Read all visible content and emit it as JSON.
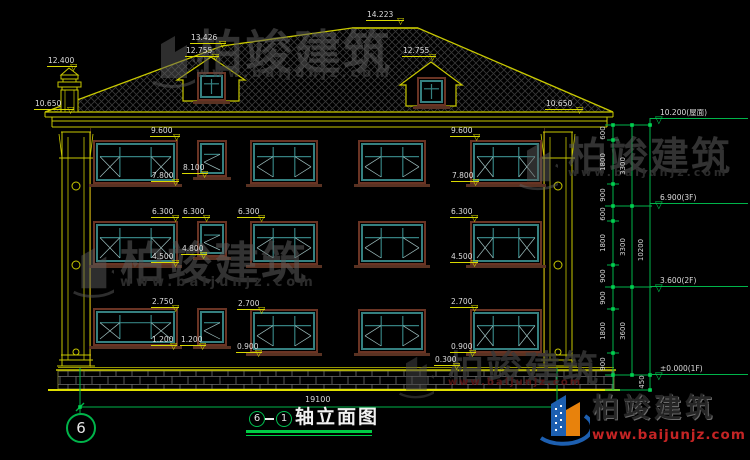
{
  "title_bar": {
    "circle_a": "6",
    "circle_b": "1",
    "title": "轴立面图",
    "axis_bubble": "6",
    "bottom_dim": "19100"
  },
  "watermark": {
    "cn": "柏竣建筑",
    "url": "www.baijunjz.com"
  },
  "brand": {
    "cn": "柏竣建筑",
    "url": "www.baijunjz.com"
  },
  "colors": {
    "line_yellow": "#c9c900",
    "dim_yellow": "#d8d800",
    "green": "#00b44a",
    "teal": "#358080",
    "frame_brown": "#6a3424",
    "text_white": "#dcdcdc",
    "brand_red": "#c42424",
    "watermark_gray": "#5c5c5c"
  },
  "drawing": {
    "marks": [
      {
        "t": "14.223",
        "x": 366,
        "y": 10,
        "w": 38
      },
      {
        "t": "13.426",
        "x": 190,
        "y": 33,
        "w": 36
      },
      {
        "t": "12.755",
        "x": 185,
        "y": 46,
        "w": 34
      },
      {
        "t": "12.400",
        "x": 47,
        "y": 56,
        "w": 30
      },
      {
        "t": "12.755",
        "x": 402,
        "y": 46,
        "w": 34
      },
      {
        "t": "10.650",
        "x": 34,
        "y": 99,
        "w": 40
      },
      {
        "t": "10.650",
        "x": 545,
        "y": 99,
        "w": 38
      },
      {
        "t": "9.600",
        "x": 150,
        "y": 126,
        "w": 30
      },
      {
        "t": "9.600",
        "x": 450,
        "y": 126,
        "w": 30
      },
      {
        "t": "8.100",
        "x": 182,
        "y": 163,
        "w": 26
      },
      {
        "t": "7.800",
        "x": 151,
        "y": 171,
        "w": 28
      },
      {
        "t": "7.800",
        "x": 451,
        "y": 171,
        "w": 28
      },
      {
        "t": "6.300",
        "x": 151,
        "y": 207,
        "w": 28
      },
      {
        "t": "6.300",
        "x": 182,
        "y": 207,
        "w": 28
      },
      {
        "t": "6.300",
        "x": 237,
        "y": 207,
        "w": 28
      },
      {
        "t": "6.300",
        "x": 450,
        "y": 207,
        "w": 28
      },
      {
        "t": "4.800",
        "x": 181,
        "y": 244,
        "w": 26
      },
      {
        "t": "4.500",
        "x": 151,
        "y": 252,
        "w": 28
      },
      {
        "t": "4.500",
        "x": 450,
        "y": 252,
        "w": 28
      },
      {
        "t": "2.750",
        "x": 151,
        "y": 297,
        "w": 28
      },
      {
        "t": "2.700",
        "x": 237,
        "y": 299,
        "w": 28
      },
      {
        "t": "2.700",
        "x": 450,
        "y": 297,
        "w": 28
      },
      {
        "t": "1.200",
        "x": 151,
        "y": 335,
        "w": 26
      },
      {
        "t": "1.200",
        "x": 180,
        "y": 335,
        "w": 26
      },
      {
        "t": "0.900",
        "x": 236,
        "y": 342,
        "w": 26
      },
      {
        "t": "0.900",
        "x": 450,
        "y": 342,
        "w": 26
      },
      {
        "t": "0.300",
        "x": 434,
        "y": 355,
        "w": 26
      }
    ],
    "right_chain": {
      "levels": [
        {
          "t": "10.200(屋面)",
          "ly": 118
        },
        {
          "t": "6.900(3F)",
          "ly": 203
        },
        {
          "t": "3.600(2F)",
          "ly": 286
        },
        {
          "t": "±0.000(1F)",
          "ly": 374
        }
      ],
      "seg_labels": [
        {
          "t": "600",
          "y": 133
        },
        {
          "t": "1800",
          "y": 162
        },
        {
          "t": "900",
          "y": 195
        },
        {
          "t": "600",
          "y": 214
        },
        {
          "t": "1800",
          "y": 243
        },
        {
          "t": "900",
          "y": 276
        },
        {
          "t": "900",
          "y": 298
        },
        {
          "t": "1800",
          "y": 331
        },
        {
          "t": "900",
          "y": 364
        }
      ],
      "group_labels": [
        {
          "t": "3300",
          "y": 166
        },
        {
          "t": "3300",
          "y": 247
        },
        {
          "t": "3600",
          "y": 331
        }
      ],
      "total_label": {
        "t": "10200",
        "y": 250
      },
      "foundation_label": {
        "t": "450",
        "y": 382
      },
      "boundaries": [
        125,
        140,
        184,
        206,
        221,
        265,
        287,
        309,
        353,
        375
      ],
      "majors": [
        125,
        206,
        287,
        375
      ],
      "ground_y": 390
    },
    "windows": [
      {
        "x": 93,
        "y": 140,
        "w": 85,
        "h": 44,
        "k": "large"
      },
      {
        "x": 197,
        "y": 140,
        "w": 30,
        "h": 37,
        "k": "small"
      },
      {
        "x": 250,
        "y": 140,
        "w": 68,
        "h": 44,
        "k": "med"
      },
      {
        "x": 358,
        "y": 140,
        "w": 68,
        "h": 44,
        "k": "med"
      },
      {
        "x": 470,
        "y": 140,
        "w": 72,
        "h": 44,
        "k": "large"
      },
      {
        "x": 93,
        "y": 221,
        "w": 85,
        "h": 44,
        "k": "large"
      },
      {
        "x": 197,
        "y": 221,
        "w": 30,
        "h": 36,
        "k": "small"
      },
      {
        "x": 250,
        "y": 221,
        "w": 68,
        "h": 44,
        "k": "med"
      },
      {
        "x": 358,
        "y": 221,
        "w": 68,
        "h": 44,
        "k": "med"
      },
      {
        "x": 470,
        "y": 221,
        "w": 72,
        "h": 44,
        "k": "large"
      },
      {
        "x": 93,
        "y": 308,
        "w": 85,
        "h": 38,
        "k": "large"
      },
      {
        "x": 197,
        "y": 308,
        "w": 30,
        "h": 38,
        "k": "small"
      },
      {
        "x": 250,
        "y": 309,
        "w": 68,
        "h": 44,
        "k": "med"
      },
      {
        "x": 358,
        "y": 309,
        "w": 68,
        "h": 44,
        "k": "med"
      },
      {
        "x": 470,
        "y": 309,
        "w": 72,
        "h": 44,
        "k": "large"
      },
      {
        "x": 197,
        "y": 72,
        "w": 29,
        "h": 29,
        "k": "dormer"
      },
      {
        "x": 417,
        "y": 77,
        "w": 29,
        "h": 29,
        "k": "dormer"
      }
    ]
  }
}
